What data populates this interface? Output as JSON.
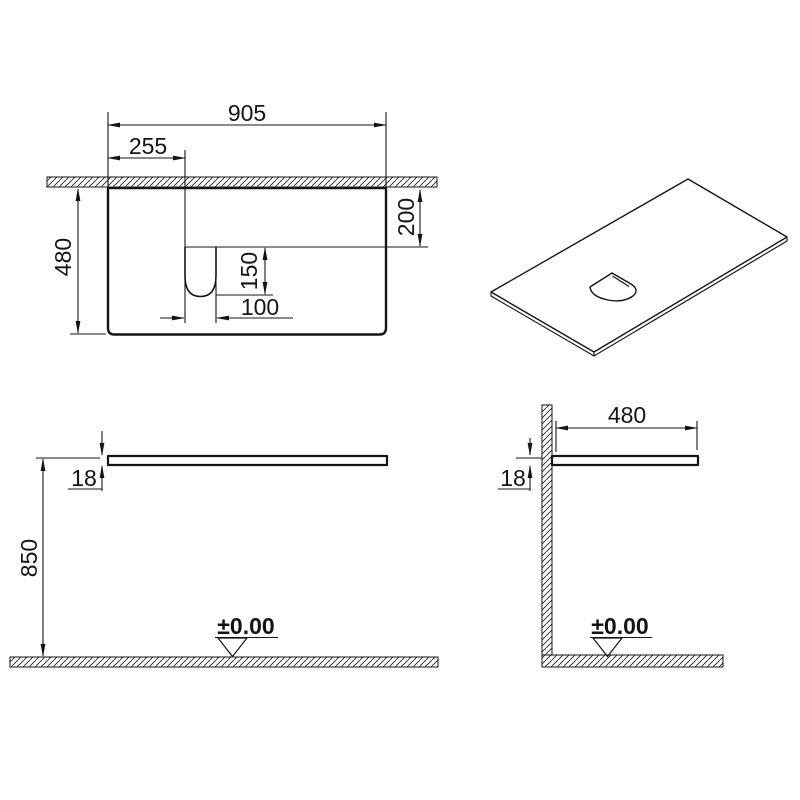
{
  "plan": {
    "width": "905",
    "cutout_from_left": "255",
    "depth": "480",
    "cutout_from_front": "200",
    "cutout_length": "150",
    "cutout_width": "100"
  },
  "front": {
    "thickness": "18",
    "height": "850",
    "datum": "±0.00"
  },
  "side": {
    "depth": "480",
    "thickness": "18",
    "datum": "±0.00"
  },
  "colors": {
    "line": "#141414",
    "background": "#ffffff"
  }
}
